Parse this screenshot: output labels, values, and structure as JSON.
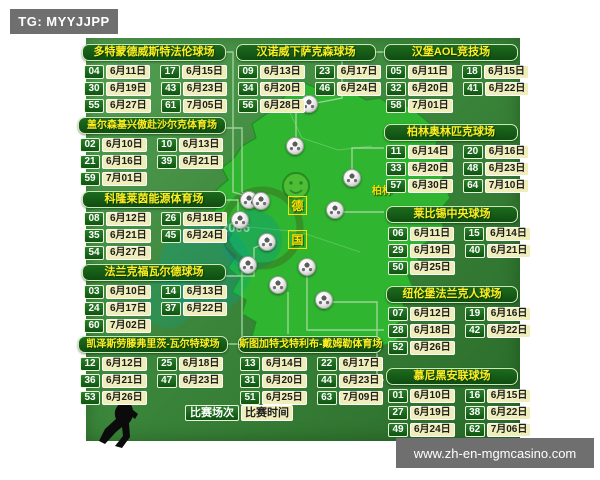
{
  "tg_badge": "TG: MYYJJPP",
  "watermark": "www.zh-en-mgmcasino.com",
  "legend": {
    "match_number_label": "比赛场次",
    "match_time_label": "比赛时间"
  },
  "map": {
    "country_name_chars": [
      "德",
      "国"
    ],
    "berlin_label": "柏林",
    "faint_logo_text": "2006"
  },
  "colors": {
    "background_green": "#3c873c",
    "map_green": "#2fb52f",
    "header_green": "#175f17",
    "number_cell_green": "#1a6b1a",
    "date_cell_yellow": "#efeebb",
    "title_yellow": "#ffee22",
    "badge_gray": "#6f6f6f"
  },
  "stadiums": [
    {
      "id": "dortmund",
      "name": "多特蒙德威斯特法伦球场",
      "matches": [
        [
          "04",
          "6月11日"
        ],
        [
          "17",
          "6月15日"
        ],
        [
          "30",
          "6月19日"
        ],
        [
          "43",
          "6月23日"
        ],
        [
          "55",
          "6月27日"
        ],
        [
          "61",
          "7月05日"
        ]
      ]
    },
    {
      "id": "hannover",
      "name": "汉诺威下萨克森球场",
      "matches": [
        [
          "09",
          "6月13日"
        ],
        [
          "23",
          "6月17日"
        ],
        [
          "34",
          "6月20日"
        ],
        [
          "46",
          "6月24日"
        ],
        [
          "56",
          "6月28日"
        ]
      ]
    },
    {
      "id": "hamburg",
      "name": "汉堡AOL竞技场",
      "matches": [
        [
          "05",
          "6月11日"
        ],
        [
          "18",
          "6月15日"
        ],
        [
          "32",
          "6月20日"
        ],
        [
          "41",
          "6月22日"
        ],
        [
          "58",
          "7月01日"
        ]
      ]
    },
    {
      "id": "gelsenkirchen",
      "name": "盖尔森基兴傲赴沙尔克体育场",
      "matches": [
        [
          "02",
          "6月10日"
        ],
        [
          "10",
          "6月13日"
        ],
        [
          "21",
          "6月16日"
        ],
        [
          "39",
          "6月21日"
        ],
        [
          "59",
          "7月01日"
        ]
      ]
    },
    {
      "id": "berlin",
      "name": "柏林奥林匹克球场",
      "matches": [
        [
          "11",
          "6月14日"
        ],
        [
          "20",
          "6月16日"
        ],
        [
          "33",
          "6月20日"
        ],
        [
          "48",
          "6月23日"
        ],
        [
          "57",
          "6月30日"
        ],
        [
          "64",
          "7月10日"
        ]
      ]
    },
    {
      "id": "cologne",
      "name": "科隆莱茵能源体育场",
      "matches": [
        [
          "08",
          "6月12日"
        ],
        [
          "26",
          "6月18日"
        ],
        [
          "35",
          "6月21日"
        ],
        [
          "45",
          "6月24日"
        ],
        [
          "54",
          "6月27日"
        ]
      ]
    },
    {
      "id": "leipzig",
      "name": "莱比锡中央球场",
      "matches": [
        [
          "06",
          "6月11日"
        ],
        [
          "15",
          "6月14日"
        ],
        [
          "29",
          "6月19日"
        ],
        [
          "40",
          "6月21日"
        ],
        [
          "50",
          "6月25日"
        ]
      ]
    },
    {
      "id": "frankfurt",
      "name": "法兰克福瓦尔德球场",
      "matches": [
        [
          "03",
          "6月10日"
        ],
        [
          "14",
          "6月13日"
        ],
        [
          "24",
          "6月17日"
        ],
        [
          "37",
          "6月22日"
        ],
        [
          "60",
          "7月02日"
        ]
      ]
    },
    {
      "id": "nuremberg",
      "name": "纽伦堡法兰克人球场",
      "matches": [
        [
          "07",
          "6月12日"
        ],
        [
          "19",
          "6月16日"
        ],
        [
          "28",
          "6月18日"
        ],
        [
          "42",
          "6月22日"
        ],
        [
          "52",
          "6月26日"
        ]
      ]
    },
    {
      "id": "kaiserslautern",
      "name": "凯泽斯劳滕弗里茨-瓦尔特球场",
      "matches": [
        [
          "12",
          "6月12日"
        ],
        [
          "25",
          "6月18日"
        ],
        [
          "36",
          "6月21日"
        ],
        [
          "47",
          "6月23日"
        ],
        [
          "53",
          "6月26日"
        ]
      ]
    },
    {
      "id": "stuttgart",
      "name": "斯图加特戈特利布-戴姆勒体育场",
      "matches": [
        [
          "13",
          "6月14日"
        ],
        [
          "22",
          "6月17日"
        ],
        [
          "31",
          "6月20日"
        ],
        [
          "44",
          "6月23日"
        ],
        [
          "51",
          "6月25日"
        ],
        [
          "63",
          "7月09日"
        ]
      ]
    },
    {
      "id": "munich",
      "name": "慕尼黑安联球场",
      "matches": [
        [
          "01",
          "6月10日"
        ],
        [
          "16",
          "6月15日"
        ],
        [
          "27",
          "6月19日"
        ],
        [
          "38",
          "6月22日"
        ],
        [
          "49",
          "6月24日"
        ],
        [
          "62",
          "7月06日"
        ]
      ]
    }
  ]
}
